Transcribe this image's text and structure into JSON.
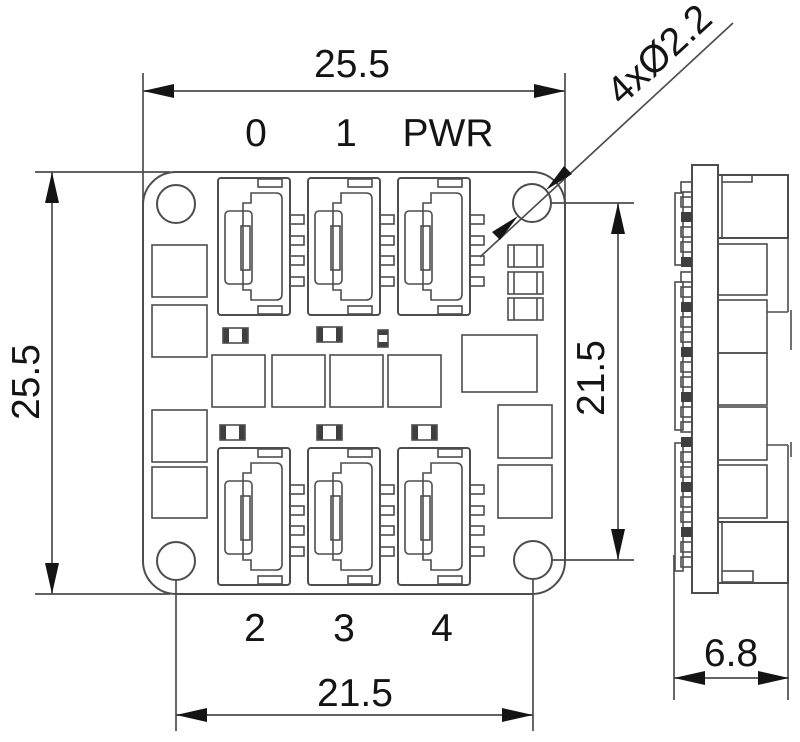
{
  "dimensions": {
    "board_width": "25.5",
    "board_height": "25.5",
    "hole_pitch_horizontal": "21.5",
    "hole_pitch_vertical": "21.5",
    "side_view_width": "6.8",
    "hole_callout": "4xØ2.2"
  },
  "connector_labels": {
    "top": [
      "0",
      "1",
      "PWR"
    ],
    "bottom": [
      "2",
      "3",
      "4"
    ]
  },
  "colors": {
    "line_color": "#4d4d4d",
    "text_color": "#141414",
    "background": "#ffffff"
  }
}
